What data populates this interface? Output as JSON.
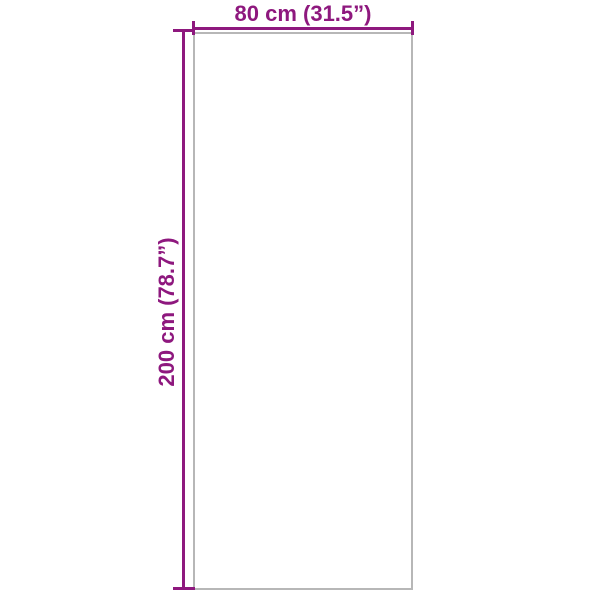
{
  "diagram": {
    "background": "#ffffff",
    "outline_color": "#b7b7b7",
    "dimension_color": "#8e187e",
    "width": {
      "label": "80 cm (31.5”)",
      "value_cm": "80",
      "value_inches": "31.5"
    },
    "height": {
      "label": "200 cm (78.7”)",
      "value_cm": "200",
      "value_inches": "78.7"
    }
  }
}
